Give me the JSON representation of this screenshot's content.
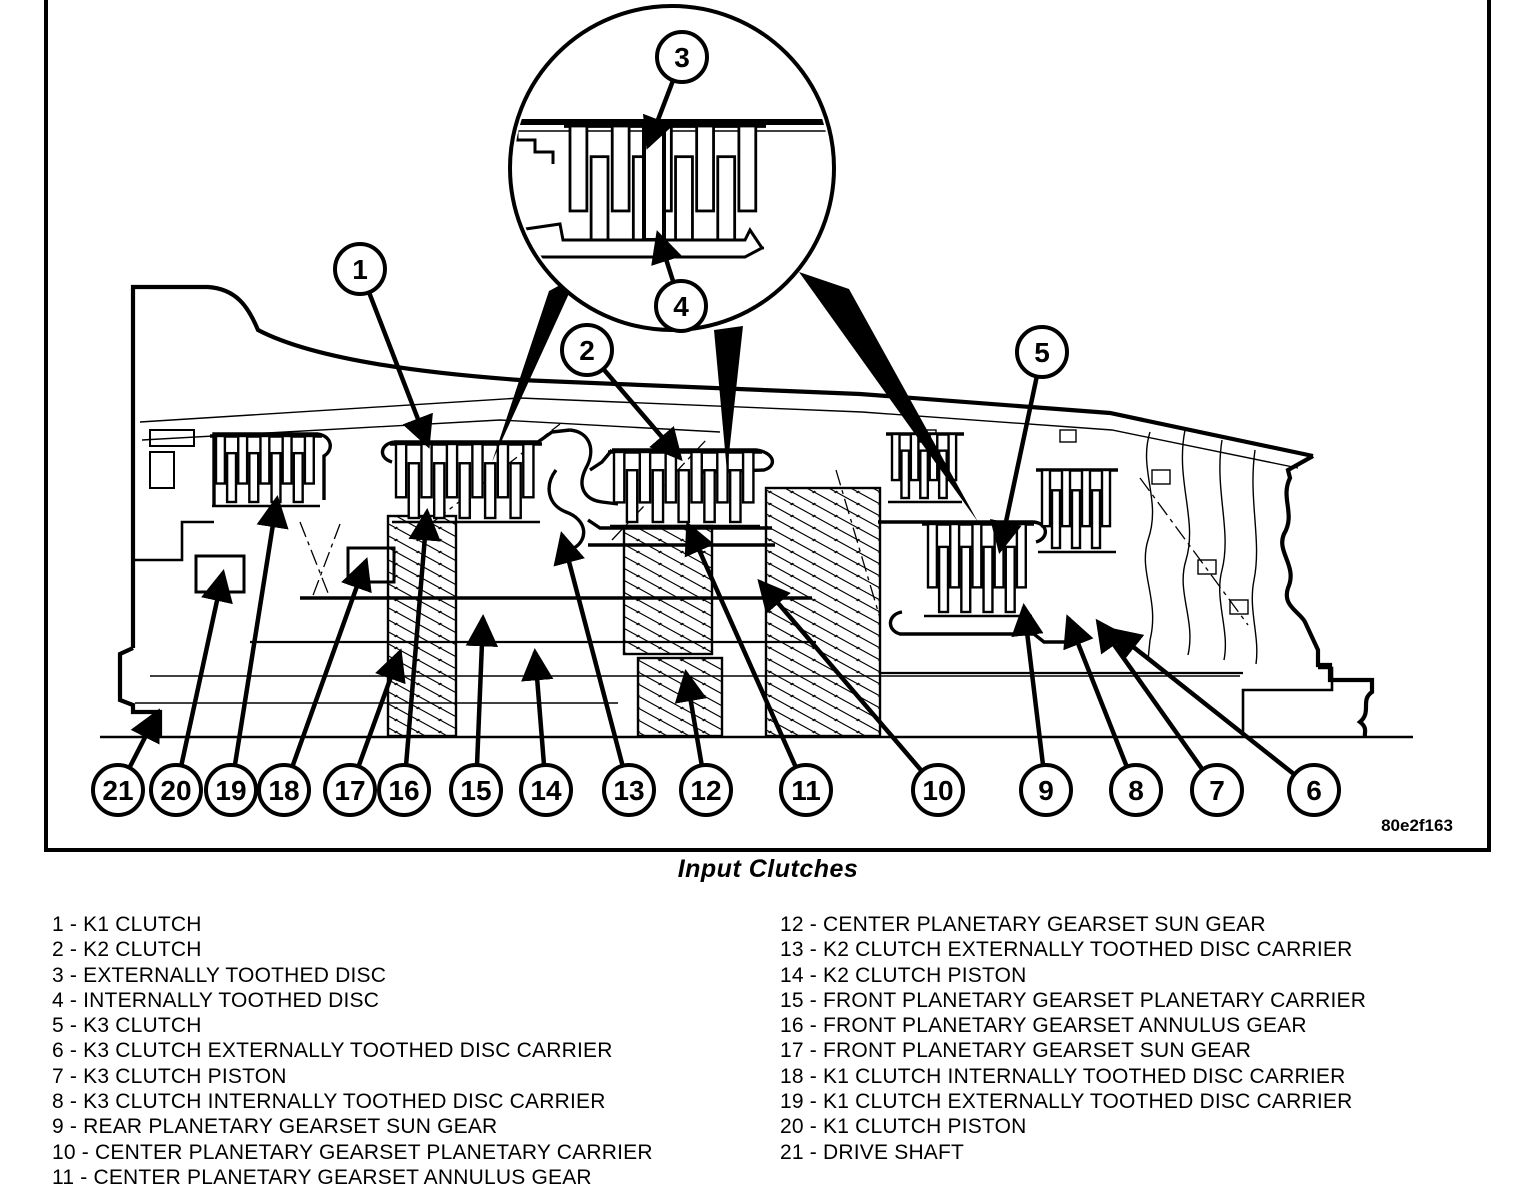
{
  "figure": {
    "caption": "Input Clutches",
    "code": "80e2f163",
    "callouts": [
      "1",
      "2",
      "3",
      "4",
      "5",
      "6",
      "7",
      "8",
      "9",
      "10",
      "11",
      "12",
      "13",
      "14",
      "15",
      "16",
      "17",
      "18",
      "19",
      "20",
      "21"
    ]
  },
  "legend": {
    "separator": "-",
    "left": [
      {
        "num": "1",
        "label": "K1 CLUTCH"
      },
      {
        "num": "2",
        "label": "K2 CLUTCH"
      },
      {
        "num": "3",
        "label": "EXTERNALLY TOOTHED DISC"
      },
      {
        "num": "4",
        "label": "INTERNALLY TOOTHED DISC"
      },
      {
        "num": "5",
        "label": "K3 CLUTCH"
      },
      {
        "num": "6",
        "label": "K3 CLUTCH EXTERNALLY TOOTHED DISC CARRIER"
      },
      {
        "num": "7",
        "label": "K3 CLUTCH PISTON"
      },
      {
        "num": "8",
        "label": "K3 CLUTCH INTERNALLY TOOTHED DISC CARRIER"
      },
      {
        "num": "9",
        "label": "REAR PLANETARY GEARSET SUN GEAR"
      },
      {
        "num": "10",
        "label": "CENTER PLANETARY GEARSET PLANETARY CARRIER"
      },
      {
        "num": "11",
        "label": "CENTER PLANETARY GEARSET ANNULUS GEAR"
      }
    ],
    "right": [
      {
        "num": "12",
        "label": "CENTER PLANETARY GEARSET SUN GEAR"
      },
      {
        "num": "13",
        "label": "K2 CLUTCH EXTERNALLY TOOTHED DISC CARRIER"
      },
      {
        "num": "14",
        "label": "K2 CLUTCH PISTON"
      },
      {
        "num": "15",
        "label": "FRONT PLANETARY GEARSET PLANETARY CARRIER"
      },
      {
        "num": "16",
        "label": "FRONT PLANETARY GEARSET ANNULUS GEAR"
      },
      {
        "num": "17",
        "label": "FRONT PLANETARY GEARSET SUN GEAR"
      },
      {
        "num": "18",
        "label": "K1 CLUTCH INTERNALLY TOOTHED DISC CARRIER"
      },
      {
        "num": "19",
        "label": "K1 CLUTCH EXTERNALLY TOOTHED DISC CARRIER"
      },
      {
        "num": "20",
        "label": "K1 CLUTCH PISTON"
      },
      {
        "num": "21",
        "label": "DRIVE SHAFT"
      }
    ]
  },
  "colors": {
    "ink": "#000000",
    "paper": "#ffffff"
  }
}
